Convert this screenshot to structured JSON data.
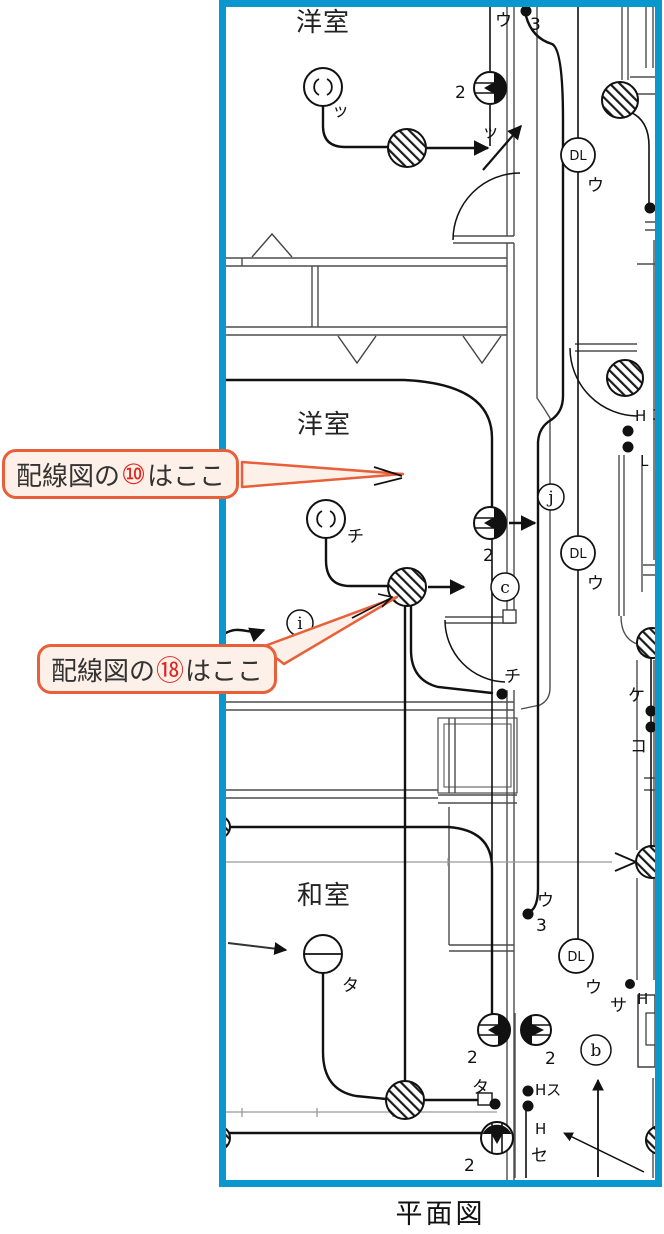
{
  "colors": {
    "frame": "#0997cd",
    "callout_border": "#e8603a",
    "callout_fill": "#fdf0e8",
    "callout_number": "#e0241f",
    "ink": "#1a1a1a"
  },
  "caption": "平面図",
  "rooms": {
    "top": "洋室",
    "middle": "洋室",
    "bottom": "和室"
  },
  "callouts": {
    "ten": {
      "prefix": "配線図の",
      "number": "⑩",
      "suffix": "はここ"
    },
    "eighteen": {
      "prefix": "配線図の",
      "number": "⑱",
      "suffix": "はここ"
    }
  },
  "symbols": {
    "downlight": "DL",
    "circuit_j": "j",
    "circuit_c": "c",
    "circuit_i": "i",
    "circuit_b": "b"
  },
  "labels": {
    "rose_top": "ッ",
    "door_top_switch": "ッ",
    "outlet_top_count": "2",
    "sw_top": "ウ",
    "sw_top_ways": "3",
    "dl_top": "ウ",
    "rose_mid": "チ",
    "outlet_mid_count": "2",
    "dl_mid": "ウ",
    "right_h_top": "H",
    "right_3": "3",
    "right_l": "L",
    "right_ke": "ケ",
    "right_ko": "コ",
    "sw_chi": "チ",
    "sw_bottom": "ウ",
    "sw_bottom_ways": "3",
    "dl_bottom": "ウ",
    "dl_bottom_sa": "サ",
    "right_h_mid": "H",
    "light_ta": "タ",
    "outlet_pair_left_count": "2",
    "outlet_pair_right_count": "2",
    "sw_ta": "タ",
    "sw_hs": "Hス",
    "sw_h": "H",
    "sw_se": "セ",
    "outlet_bottom_count": "2"
  }
}
